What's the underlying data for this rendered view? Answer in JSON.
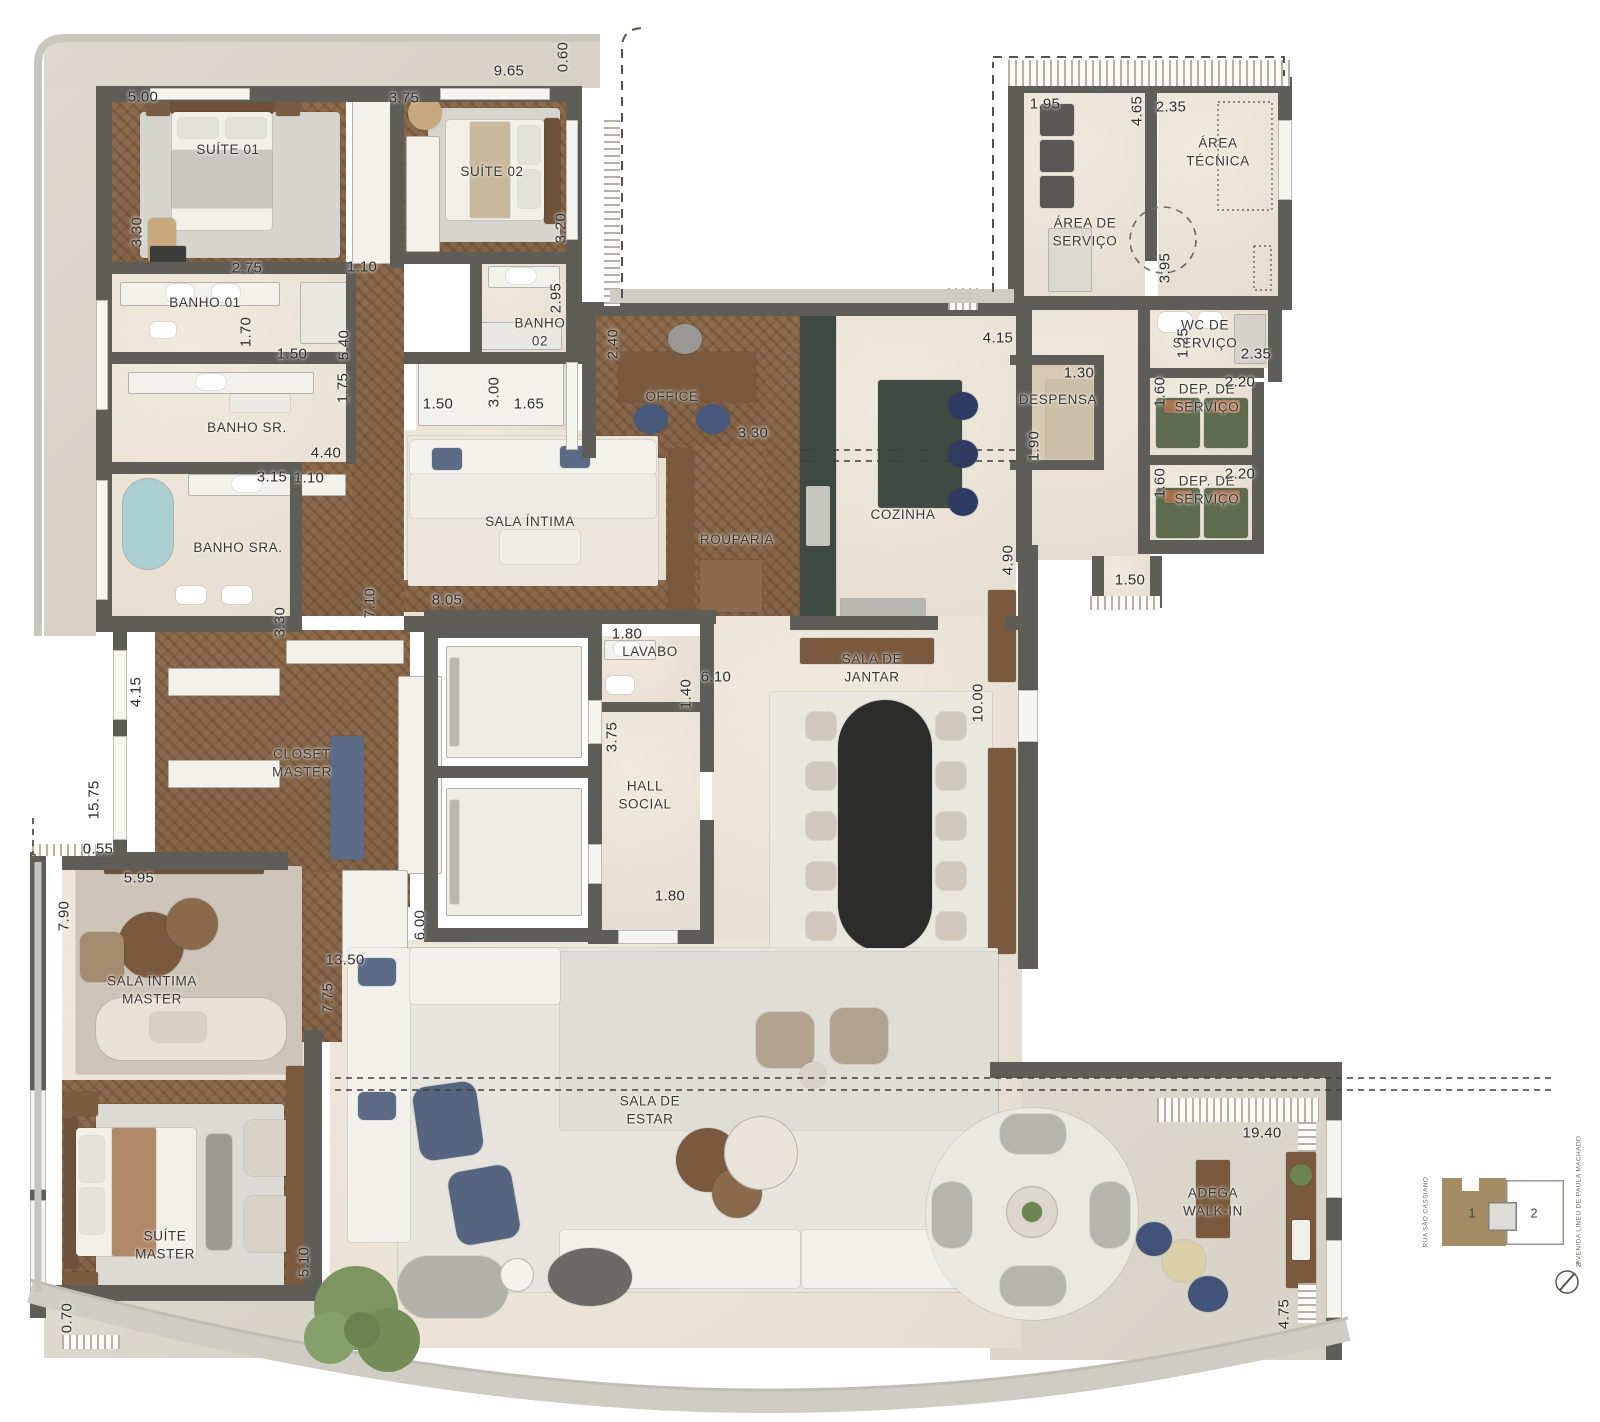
{
  "colors": {
    "wall": "#5f5d58",
    "wood": "#8a6a4c",
    "marble": "#ece6da",
    "terrace": "#d8d4c9",
    "green_marble": "#3f4a42",
    "black_marble": "#2c2c2a",
    "navy": "#45587a",
    "tub_blue": "#a9cfd3",
    "tree_green": "#7d9661",
    "unit1_brown": "#a38c63"
  },
  "rooms": [
    {
      "id": "suite-01",
      "label": "SUÍTE 01",
      "x": 228,
      "y": 150
    },
    {
      "id": "suite-02",
      "label": "SUÍTE 02",
      "x": 492,
      "y": 172
    },
    {
      "id": "banho-01",
      "label": "BANHO 01",
      "x": 205,
      "y": 303
    },
    {
      "id": "banho-02",
      "label": "BANHO\n02",
      "x": 540,
      "y": 332
    },
    {
      "id": "banho-sr",
      "label": "BANHO SR.",
      "x": 247,
      "y": 428
    },
    {
      "id": "banho-sra",
      "label": "BANHO SRA.",
      "x": 238,
      "y": 548
    },
    {
      "id": "office",
      "label": "OFFICE",
      "x": 672,
      "y": 397
    },
    {
      "id": "sala-intima",
      "label": "SALA ÍNTIMA",
      "x": 530,
      "y": 522
    },
    {
      "id": "rouparia",
      "label": "ROUPARIA",
      "x": 737,
      "y": 540
    },
    {
      "id": "cozinha",
      "label": "COZINHA",
      "x": 903,
      "y": 515
    },
    {
      "id": "despensa",
      "label": "DESPENSA",
      "x": 1058,
      "y": 400
    },
    {
      "id": "area-de-servico",
      "label": "ÁREA DE\nSERVIÇO",
      "x": 1085,
      "y": 232
    },
    {
      "id": "area-tecnica",
      "label": "ÁREA\nTÉCNICA",
      "x": 1218,
      "y": 152
    },
    {
      "id": "wc-de-servico",
      "label": "WC DE\nSERVIÇO",
      "x": 1205,
      "y": 334
    },
    {
      "id": "dep-de-servico-1",
      "label": "DEP. DE\nSERVIÇO",
      "x": 1207,
      "y": 398
    },
    {
      "id": "dep-de-servico-2",
      "label": "DEP. DE\nSERVIÇO",
      "x": 1207,
      "y": 490
    },
    {
      "id": "lavabo",
      "label": "LAVABO",
      "x": 650,
      "y": 652
    },
    {
      "id": "hall-social",
      "label": "HALL\nSOCIAL",
      "x": 645,
      "y": 795
    },
    {
      "id": "sala-de-jantar",
      "label": "SALA DE\nJANTAR",
      "x": 872,
      "y": 668
    },
    {
      "id": "closet-master",
      "label": "CLOSET\nMASTER",
      "x": 302,
      "y": 763
    },
    {
      "id": "sala-intima-master",
      "label": "SALA ÍNTIMA\nMASTER",
      "x": 152,
      "y": 990
    },
    {
      "id": "suite-master",
      "label": "SUÍTE\nMASTER",
      "x": 165,
      "y": 1245
    },
    {
      "id": "sala-de-estar",
      "label": "SALA DE\nESTAR",
      "x": 650,
      "y": 1110
    },
    {
      "id": "adega-walk-in",
      "label": "ADEGA\nWALK-IN",
      "x": 1213,
      "y": 1202
    }
  ],
  "dims": [
    {
      "t": "5.00",
      "x": 143,
      "y": 97,
      "v": false
    },
    {
      "t": "3.30",
      "x": 137,
      "y": 232,
      "v": true
    },
    {
      "t": "9.65",
      "x": 509,
      "y": 71,
      "v": false
    },
    {
      "t": "0.60",
      "x": 563,
      "y": 57,
      "v": true
    },
    {
      "t": "3.75",
      "x": 404,
      "y": 98,
      "v": false
    },
    {
      "t": "3.20",
      "x": 561,
      "y": 228,
      "v": true
    },
    {
      "t": "2.75",
      "x": 247,
      "y": 268,
      "v": false
    },
    {
      "t": "1.10",
      "x": 362,
      "y": 267,
      "v": false
    },
    {
      "t": "2.95",
      "x": 556,
      "y": 298,
      "v": true
    },
    {
      "t": "1.70",
      "x": 246,
      "y": 332,
      "v": true
    },
    {
      "t": "1.50",
      "x": 292,
      "y": 354,
      "v": false
    },
    {
      "t": "5.40",
      "x": 344,
      "y": 345,
      "v": true
    },
    {
      "t": "1.75",
      "x": 343,
      "y": 388,
      "v": true
    },
    {
      "t": "2.40",
      "x": 613,
      "y": 344,
      "v": true
    },
    {
      "t": "1.50",
      "x": 438,
      "y": 404,
      "v": false
    },
    {
      "t": "3.00",
      "x": 494,
      "y": 392,
      "v": true
    },
    {
      "t": "1.65",
      "x": 529,
      "y": 404,
      "v": false
    },
    {
      "t": "4.40",
      "x": 326,
      "y": 453,
      "v": false
    },
    {
      "t": "3.15",
      "x": 272,
      "y": 477,
      "v": false
    },
    {
      "t": "1.10",
      "x": 309,
      "y": 478,
      "v": false
    },
    {
      "t": "3.30",
      "x": 280,
      "y": 622,
      "v": true
    },
    {
      "t": "3.30",
      "x": 753,
      "y": 433,
      "v": false
    },
    {
      "t": "4.15",
      "x": 998,
      "y": 338,
      "v": false
    },
    {
      "t": "1.30",
      "x": 1079,
      "y": 373,
      "v": false
    },
    {
      "t": "1.90",
      "x": 1034,
      "y": 446,
      "v": true
    },
    {
      "t": "4.90",
      "x": 1008,
      "y": 560,
      "v": true
    },
    {
      "t": "1.95",
      "x": 1045,
      "y": 104,
      "v": false
    },
    {
      "t": "4.65",
      "x": 1137,
      "y": 111,
      "v": true
    },
    {
      "t": "2.35",
      "x": 1171,
      "y": 107,
      "v": false
    },
    {
      "t": "3.95",
      "x": 1165,
      "y": 268,
      "v": true
    },
    {
      "t": "1.25",
      "x": 1183,
      "y": 343,
      "v": true
    },
    {
      "t": "2.35",
      "x": 1256,
      "y": 354,
      "v": false
    },
    {
      "t": "1.60",
      "x": 1160,
      "y": 392,
      "v": true
    },
    {
      "t": "2.20",
      "x": 1240,
      "y": 382,
      "v": false
    },
    {
      "t": "1.60",
      "x": 1160,
      "y": 483,
      "v": true
    },
    {
      "t": "2.20",
      "x": 1240,
      "y": 474,
      "v": false
    },
    {
      "t": "1.50",
      "x": 1130,
      "y": 580,
      "v": false
    },
    {
      "t": "7.10",
      "x": 370,
      "y": 603,
      "v": true
    },
    {
      "t": "8.05",
      "x": 447,
      "y": 600,
      "v": false
    },
    {
      "t": "1.80",
      "x": 627,
      "y": 634,
      "v": false
    },
    {
      "t": "6.10",
      "x": 716,
      "y": 677,
      "v": false
    },
    {
      "t": "1.40",
      "x": 686,
      "y": 694,
      "v": true
    },
    {
      "t": "3.75",
      "x": 612,
      "y": 737,
      "v": true
    },
    {
      "t": "10.00",
      "x": 978,
      "y": 703,
      "v": true
    },
    {
      "t": "1.80",
      "x": 670,
      "y": 896,
      "v": false
    },
    {
      "t": "4.15",
      "x": 136,
      "y": 692,
      "v": true
    },
    {
      "t": "15.75",
      "x": 94,
      "y": 800,
      "v": true
    },
    {
      "t": "0.55",
      "x": 98,
      "y": 849,
      "v": false
    },
    {
      "t": "5.95",
      "x": 139,
      "y": 878,
      "v": false
    },
    {
      "t": "7.90",
      "x": 64,
      "y": 916,
      "v": true
    },
    {
      "t": "6.00",
      "x": 420,
      "y": 925,
      "v": true
    },
    {
      "t": "13.50",
      "x": 345,
      "y": 960,
      "v": false
    },
    {
      "t": "7.75",
      "x": 328,
      "y": 998,
      "v": true
    },
    {
      "t": "5.10",
      "x": 304,
      "y": 1262,
      "v": true
    },
    {
      "t": "0.70",
      "x": 67,
      "y": 1318,
      "v": true
    },
    {
      "t": "19.40",
      "x": 1262,
      "y": 1133,
      "v": false
    },
    {
      "t": "4.75",
      "x": 1284,
      "y": 1314,
      "v": true
    }
  ],
  "legend": {
    "unit1": "1",
    "unit2": "2",
    "street_left": "RUA SÃO CASSIANO",
    "street_right": "AVENIDA LINEU DE PAULA MACHADO",
    "north": "N"
  }
}
